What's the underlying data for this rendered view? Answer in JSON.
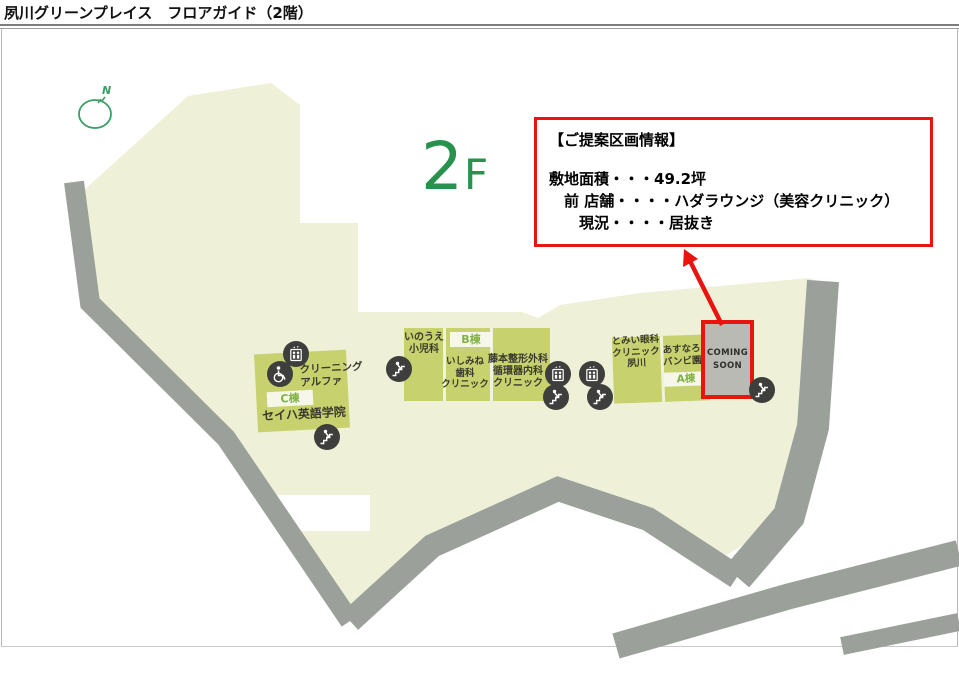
{
  "header": {
    "title": "夙川グリーンプレイス　フロアガイド（2階）"
  },
  "floor": {
    "number": "2",
    "suffix": "F"
  },
  "compass": {
    "label": "N"
  },
  "callout": {
    "title": "【ご提案区画情報】",
    "lines": [
      "敷地面積・・・49.2坪",
      "　前 店舗・・・・ハダラウンジ（美容クリニック）",
      "　　現況・・・・居抜き"
    ]
  },
  "buildings": {
    "c": {
      "label": "C棟",
      "tenants": [
        "クリーニング\nアルファ",
        "セイハ英語学院"
      ]
    },
    "b": {
      "label": "B棟",
      "tenants": [
        "いのうえ\n小児科",
        "いしみね\n歯科\nクリニック",
        "藤本整形外科\n循環器内科\nクリニック"
      ]
    },
    "a": {
      "label": "A棟",
      "tenants": [
        "とみい眼科\nクリニック\n夙川",
        "あすなろ\nバンビ園"
      ]
    },
    "vacant": {
      "label": "COMING\nSOON"
    }
  },
  "icons": {
    "elevator": "elevator-icon",
    "stairs": "stairs-icon",
    "wheelchair": "wheelchair-icon",
    "compass": "compass-icon"
  },
  "colors": {
    "site": "#eef0d8",
    "building": "#c7d26e",
    "road": "#9ba19a",
    "accent_red": "#e71410",
    "floor_green": "#27914d",
    "banner_bg": "#f6f7e9",
    "banner_text": "#7eb33f",
    "icon_bg": "#3e3e3c",
    "vacant_bg": "#b9bab4"
  }
}
